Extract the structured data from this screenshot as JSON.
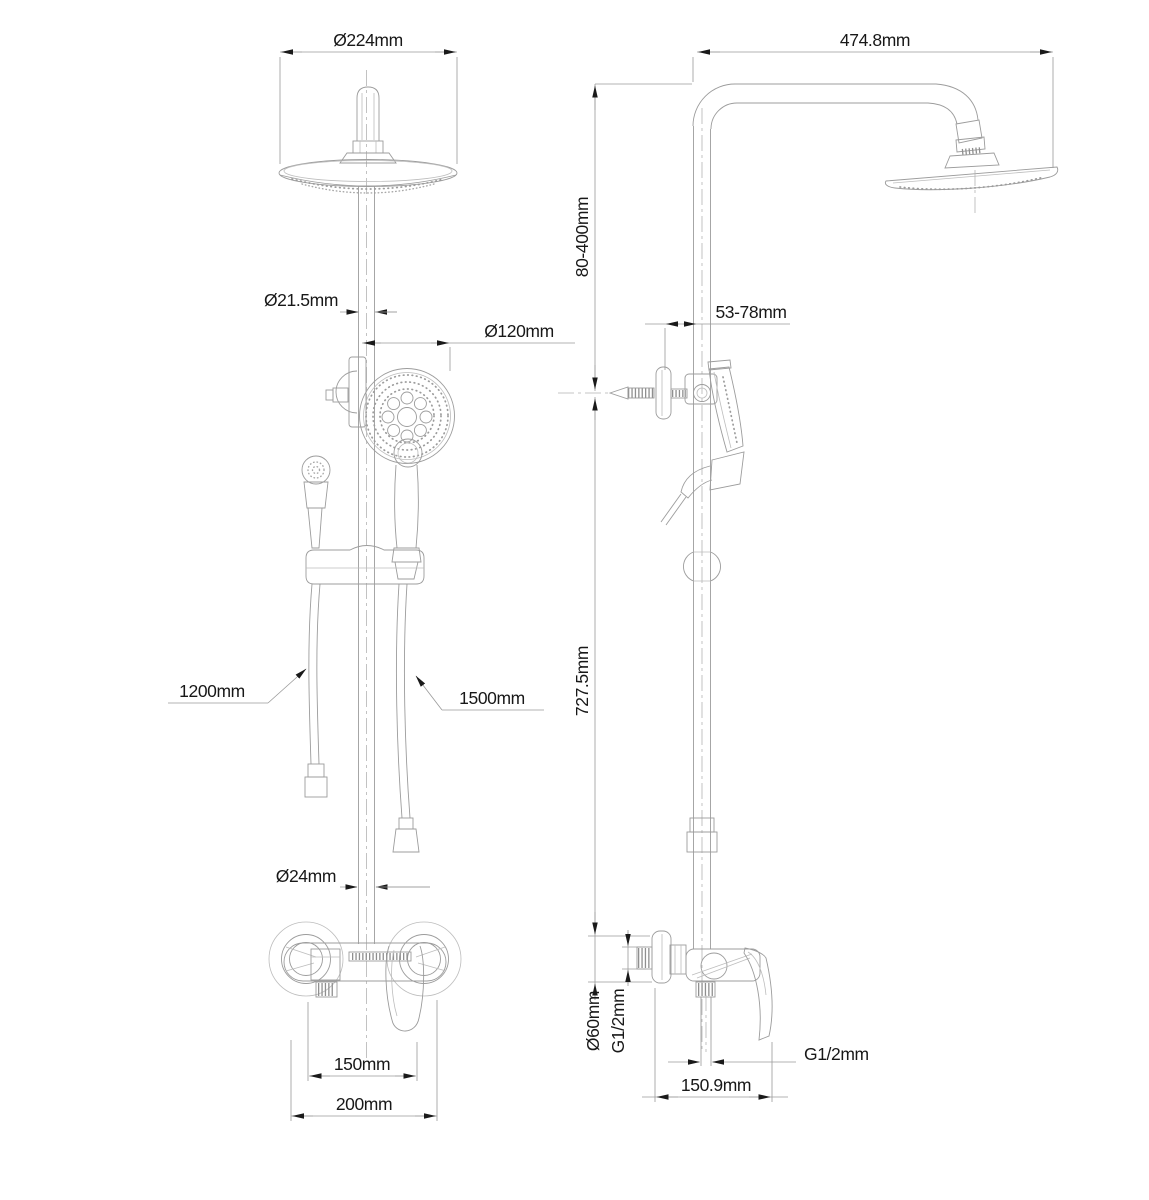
{
  "drawing_type": "shower-system-technical-drawing",
  "colors": {
    "background": "#ffffff",
    "line": "#9c9c9c",
    "arrow": "#1a1a1a",
    "text": "#181818"
  },
  "front_view": {
    "dims": {
      "overhead_diameter": "Ø224mm",
      "riser_diameter": "Ø21.5mm",
      "handshower_diameter": "Ø120mm",
      "sprayer_hose_length": "1200mm",
      "shower_hose_length": "1500mm",
      "lower_riser_diameter": "Ø24mm",
      "inlet_center_distance": "150mm",
      "mixer_overall_width": "200mm"
    }
  },
  "side_view": {
    "dims": {
      "arm_reach": "474.8mm",
      "bracket_height_range": "80-400mm",
      "bracket_wall_offset": "53-78mm",
      "riser_length": "727.5mm",
      "escutcheon_diameter": "Ø60mm",
      "inlet_thread": "G1/2mm",
      "outlet_thread": "G1/2mm",
      "mixer_depth": "150.9mm"
    }
  }
}
